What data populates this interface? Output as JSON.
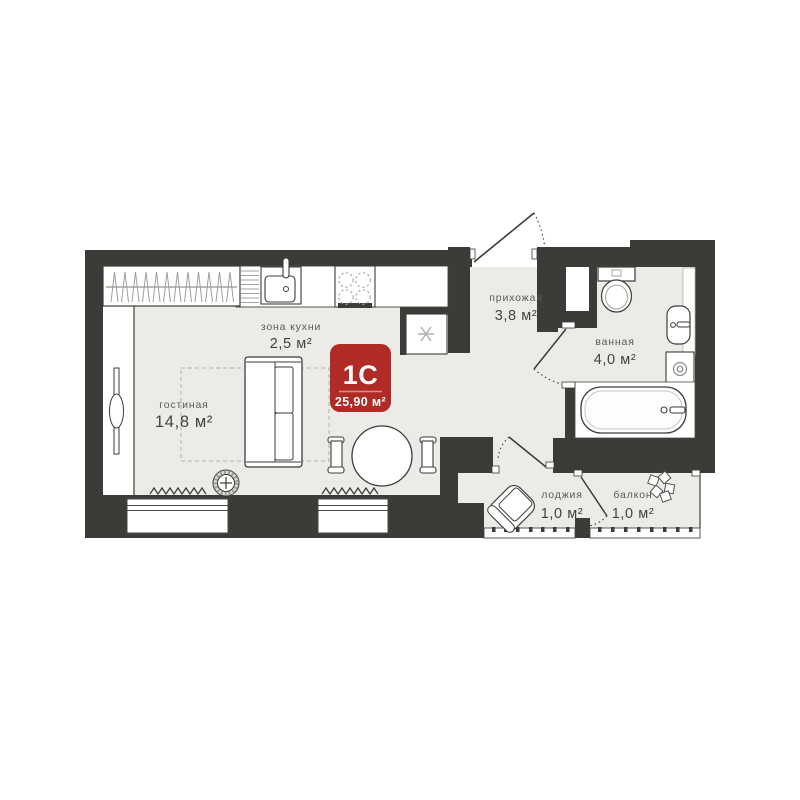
{
  "plan": {
    "badge": {
      "type_label": "1С",
      "total_area": "25,90 м²"
    },
    "rooms": {
      "kitchen_zone": {
        "label": "зона кухни",
        "area": "2,5 м²"
      },
      "living_room": {
        "label": "гостиная",
        "area": "14,8 м²"
      },
      "hallway": {
        "label": "прихожая",
        "area": "3,8 м²"
      },
      "bathroom": {
        "label": "ванная",
        "area": "4,0 м²"
      },
      "loggia": {
        "label": "лоджия",
        "area": "1,0 м²"
      },
      "balcony": {
        "label": "балкон",
        "area": "1,0 м²"
      }
    },
    "icons": [
      "snowflake-fridge-icon",
      "stove-burners-icon",
      "kitchen-sink-icon",
      "dish-rack-icon",
      "hangers-icon",
      "toilet-icon",
      "bathroom-sink-icon",
      "washing-machine-icon",
      "bathtub-icon",
      "sofa-icon",
      "dining-table-icon",
      "floor-lamp-icon",
      "armchair-icon",
      "plant-icon",
      "radiator-wave-icon",
      "door-swing-icon"
    ],
    "colors": {
      "wall": "#3d3b38",
      "floor": "#ecebe8",
      "accent_red": "#b02a26",
      "light_stroke": "#a7a5a2",
      "label_text": "#5c5a56"
    }
  }
}
